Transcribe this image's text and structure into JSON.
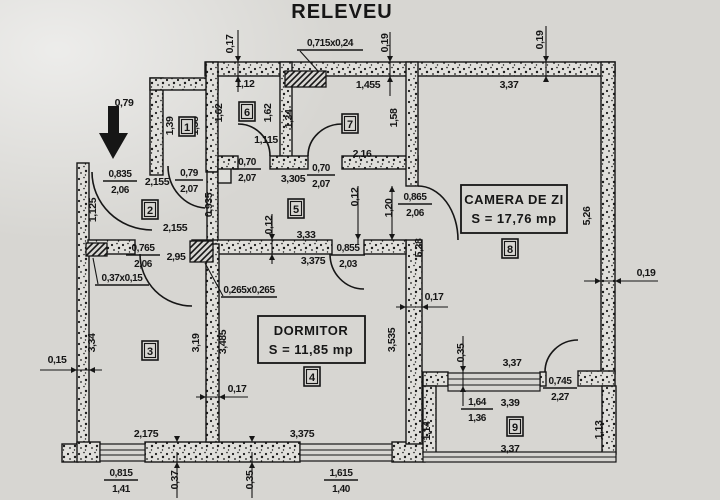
{
  "title": "RELEVEU",
  "plan": {
    "room_boxes": [
      {
        "name": "CAMERA DE ZI",
        "area": "S = 17,76 mp"
      },
      {
        "name": "DORMITOR",
        "area": "S = 11,85 mp"
      }
    ],
    "room_numbers": [
      "1",
      "2",
      "3",
      "4",
      "5",
      "6",
      "7",
      "8",
      "9"
    ],
    "dims_h": [
      "0,79",
      "1,12",
      "1,455",
      "3,37",
      "1,115",
      "3,305",
      "2,155",
      "2,16",
      "2,155",
      "3,33",
      "2,95",
      "3,375",
      "0,17",
      "0,17",
      "0,15",
      "0,19",
      "2,175",
      "3,375",
      "3,37",
      "3,39",
      "3,37"
    ],
    "dims_v": [
      "0,17",
      "0,19",
      "0,19",
      "1,39",
      "1,38",
      "1,62",
      "1,62",
      "1,34",
      "1,58",
      "0,935",
      "1,125",
      "5,26",
      "0,12",
      "0,12",
      "1,20",
      "5,28",
      "3,34",
      "3,19",
      "3,485",
      "3,535",
      "0,35",
      "1,14",
      "1,13",
      "0,37",
      "0,35"
    ],
    "fractions": [
      {
        "num": "0,835",
        "den": "2,06"
      },
      {
        "num": "0,79",
        "den": "2,07"
      },
      {
        "num": "0,70",
        "den": "2,07"
      },
      {
        "num": "0,70",
        "den": "2,07"
      },
      {
        "num": "0,765",
        "den": "2,06"
      },
      {
        "num": "0,855",
        "den": "2,03"
      },
      {
        "num": "0,865",
        "den": "2,06"
      },
      {
        "num": "0,745",
        "den": "2,27"
      },
      {
        "num": "0,815",
        "den": "1,41"
      },
      {
        "num": "1,615",
        "den": "1,40"
      },
      {
        "num": "1,64",
        "den": "1,36"
      }
    ],
    "vents": [
      "0,715x0,24",
      "0,37x0,15",
      "0,265x0,265"
    ],
    "colors": {
      "paper": "#d7d6d2",
      "ink": "#161616"
    }
  }
}
